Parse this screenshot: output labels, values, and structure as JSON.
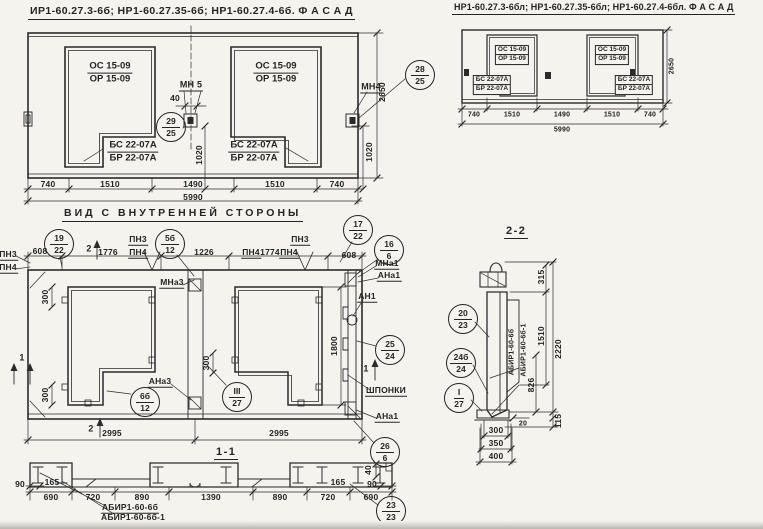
{
  "colors": {
    "paper": "#f4f3ee",
    "ink": "#242424"
  },
  "titles": {
    "facade_left": "ИР1-60.27.3-6б; НР1-60.27.35-6б; НР1-60.27.4-6б. Ф А С А Д",
    "facade_right": "НР1-60.27.3-6бл; НР1-60.27.35-6бл; НР1-60.27.4-6бл. Ф А С А Д",
    "inner_view": "ВИД С ВНУТРЕННЕЙ СТОРОНЫ",
    "section_1": "1-1",
    "section_2": "2-2"
  },
  "fl": {
    "t_os": "ОС 15-09",
    "t_or": "ОР 15-09",
    "t_bs": "БС 22-07А",
    "t_br": "БР 22-07А",
    "mn5": "МН 5",
    "mn4": "МН4",
    "d40": "40",
    "d1020": "1020",
    "d2650": "2650",
    "dims": [
      "740",
      "1510",
      "1490",
      "1510",
      "740"
    ],
    "total": "5990",
    "c29": {
      "t": "29",
      "b": "25"
    },
    "c28": {
      "t": "28",
      "b": "25"
    }
  },
  "fr": {
    "t_os": "ОС 15-09",
    "t_or": "ОР 15-09",
    "t_bs": "БС 22-07А",
    "t_br": "БР 22-07А",
    "d2650": "2650",
    "dims": [
      "740",
      "1510",
      "1490",
      "1510",
      "740"
    ],
    "total": "5990"
  },
  "iv": {
    "pn3": "ПН3",
    "pn4": "ПН4",
    "d608": "608",
    "d1776": "1776",
    "d1226": "1226",
    "d1774": "1774",
    "d300": "300",
    "d1800": "1800",
    "d2995": "2995",
    "mna3": "МНа3",
    "ana3": "АНа3",
    "mna1": "МНа1",
    "ana1": "АНа1",
    "an1": "АН1",
    "shponki": "ШПОНКИ",
    "s1": "1",
    "s2": "2",
    "c19": {
      "t": "19",
      "b": "22"
    },
    "c5": {
      "t": "5б",
      "b": "12"
    },
    "c17": {
      "t": "17",
      "b": "22"
    },
    "c16": {
      "t": "16",
      "b": "6"
    },
    "c6": {
      "t": "6б",
      "b": "12"
    },
    "c3": {
      "t": "III",
      "b": "27"
    },
    "c25": {
      "t": "25",
      "b": "24"
    },
    "c26": {
      "t": "26",
      "b": "6"
    }
  },
  "s11": {
    "d90": "90",
    "d165": "165",
    "d690": "690",
    "d720": "720",
    "d890": "890",
    "d1390": "1390",
    "d40": "40",
    "lbl1": "АБИР1-60-6б",
    "lbl2": "АБИР1-60-6б-1",
    "c23": {
      "t": "23",
      "b": "23"
    }
  },
  "s22": {
    "d315": "315",
    "d1510": "1510",
    "d2220": "2220",
    "d826": "826",
    "d115": "115",
    "d20": "20",
    "d300": "300",
    "d350": "350",
    "d400": "400",
    "lbl1": "АБИР1-60-6б",
    "lbl2": "АБИР1-60-6б-1",
    "c20": {
      "t": "20",
      "b": "23"
    },
    "c24": {
      "t": "24б",
      "b": "24"
    },
    "c1": {
      "t": "I",
      "b": "27"
    }
  }
}
